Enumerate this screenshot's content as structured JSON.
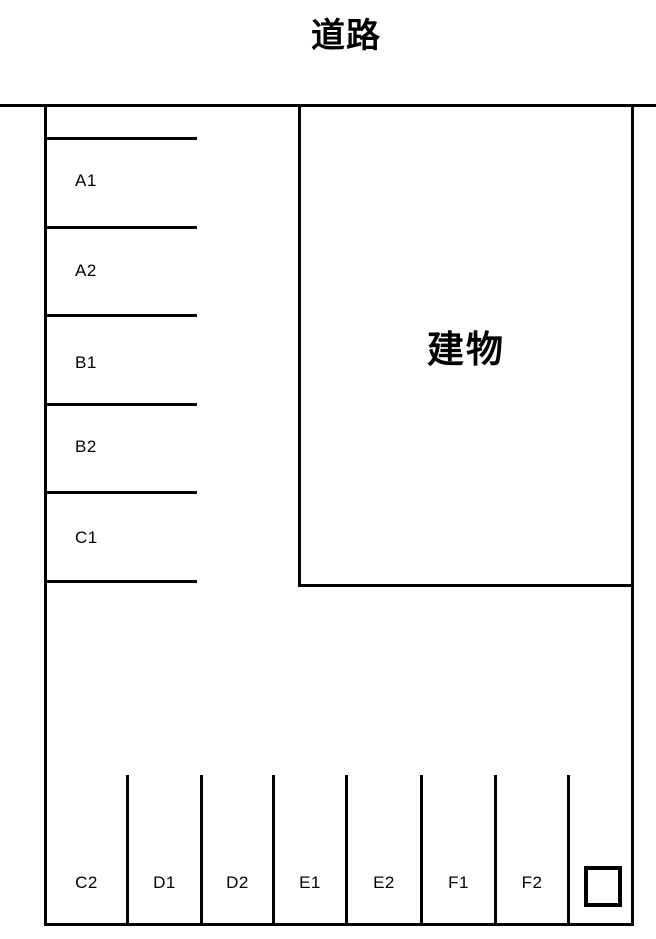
{
  "colors": {
    "background": "#ffffff",
    "line": "#000000",
    "text": "#000000"
  },
  "road": {
    "label": "道路"
  },
  "building": {
    "label": "建物"
  },
  "parking": {
    "left_column": [
      {
        "label": "A1"
      },
      {
        "label": "A2"
      },
      {
        "label": "B1"
      },
      {
        "label": "B2"
      },
      {
        "label": "C1"
      }
    ],
    "bottom_row": [
      {
        "label": "C2"
      },
      {
        "label": "D1"
      },
      {
        "label": "D2"
      },
      {
        "label": "E1"
      },
      {
        "label": "E2"
      },
      {
        "label": "F1"
      },
      {
        "label": "F2"
      }
    ]
  }
}
